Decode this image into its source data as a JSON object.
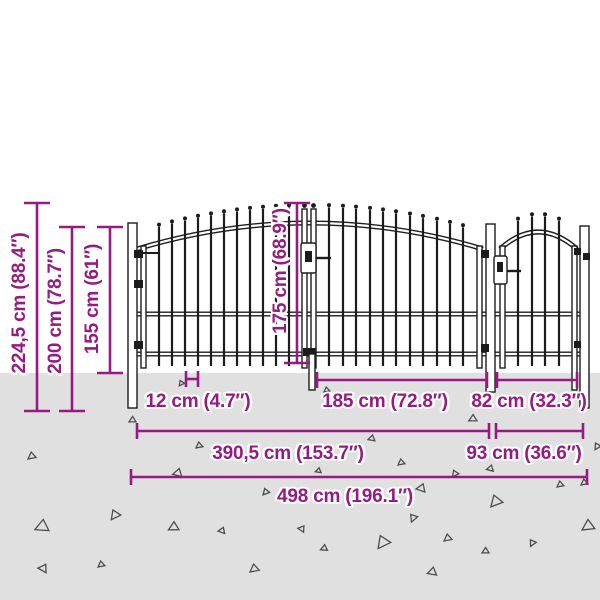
{
  "page": {
    "background_color": "#ffffff",
    "ground_color": "#e1e0e0",
    "accent_color": "#951b81",
    "fence_color": "#1c1c1c"
  },
  "labels": {
    "total_height": "224,5 cm (88.4″)",
    "post_height": "200 cm (78.7″)",
    "fence_height": "155 cm (61″)",
    "gate_height": "175 cm (68.9″)",
    "bar_spacing": "12 cm (4.7″)",
    "left_gate_width": "185 cm (72.8″)",
    "right_gate_width": "82 cm (32.3″)",
    "double_gate_width": "390,5 cm (153.7″)",
    "side_section_width": "93 cm (36.6″)",
    "total_width": "498 cm (196.1″)"
  },
  "ground": {
    "triangles": [
      {
        "x": 28,
        "y": 452,
        "s": 7,
        "r": 0
      },
      {
        "x": 38,
        "y": 518,
        "s": 12,
        "r": 15
      },
      {
        "x": 43,
        "y": 562,
        "s": 8,
        "r": 40
      },
      {
        "x": 98,
        "y": 561,
        "s": 6,
        "r": 0
      },
      {
        "x": 109,
        "y": 511,
        "s": 9,
        "r": -15
      },
      {
        "x": 130,
        "y": 416,
        "s": 6,
        "r": 10
      },
      {
        "x": 170,
        "y": 521,
        "s": 9,
        "r": 10
      },
      {
        "x": 176,
        "y": 467,
        "s": 8,
        "r": 25
      },
      {
        "x": 178,
        "y": 381,
        "s": 5,
        "r": -15
      },
      {
        "x": 196,
        "y": 442,
        "s": 6,
        "r": 0
      },
      {
        "x": 221,
        "y": 526,
        "s": 6,
        "r": 30
      },
      {
        "x": 250,
        "y": 564,
        "s": 8,
        "r": 0
      },
      {
        "x": 262,
        "y": 489,
        "s": 6,
        "r": -10
      },
      {
        "x": 302,
        "y": 524,
        "s": 6,
        "r": 45
      },
      {
        "x": 317,
        "y": 467,
        "s": 5,
        "r": 20
      },
      {
        "x": 322,
        "y": 544,
        "s": 6,
        "r": 15
      },
      {
        "x": 324,
        "y": 387,
        "s": 5,
        "r": 0
      },
      {
        "x": 370,
        "y": 434,
        "s": 6,
        "r": 20
      },
      {
        "x": 375,
        "y": 537,
        "s": 12,
        "r": -15
      },
      {
        "x": 398,
        "y": 459,
        "s": 6,
        "r": 0
      },
      {
        "x": 408,
        "y": 516,
        "s": 7,
        "r": -30
      },
      {
        "x": 420,
        "y": 482,
        "s": 8,
        "r": 30
      },
      {
        "x": 430,
        "y": 566,
        "s": 8,
        "r": 20
      },
      {
        "x": 444,
        "y": 534,
        "s": 7,
        "r": 0
      },
      {
        "x": 451,
        "y": 471,
        "s": 6,
        "r": -15
      },
      {
        "x": 470,
        "y": 414,
        "s": 7,
        "r": 10
      },
      {
        "x": 483,
        "y": 547,
        "s": 6,
        "r": 10
      },
      {
        "x": 489,
        "y": 464,
        "s": 6,
        "r": 25
      },
      {
        "x": 489,
        "y": 496,
        "s": 11,
        "r": -10
      },
      {
        "x": 528,
        "y": 541,
        "s": 6,
        "r": -25
      },
      {
        "x": 557,
        "y": 481,
        "s": 6,
        "r": 0
      },
      {
        "x": 581,
        "y": 479,
        "s": 6,
        "r": 0
      },
      {
        "x": 583,
        "y": 519,
        "s": 11,
        "r": 5
      },
      {
        "x": 593,
        "y": 444,
        "s": 6,
        "r": -20
      }
    ]
  }
}
